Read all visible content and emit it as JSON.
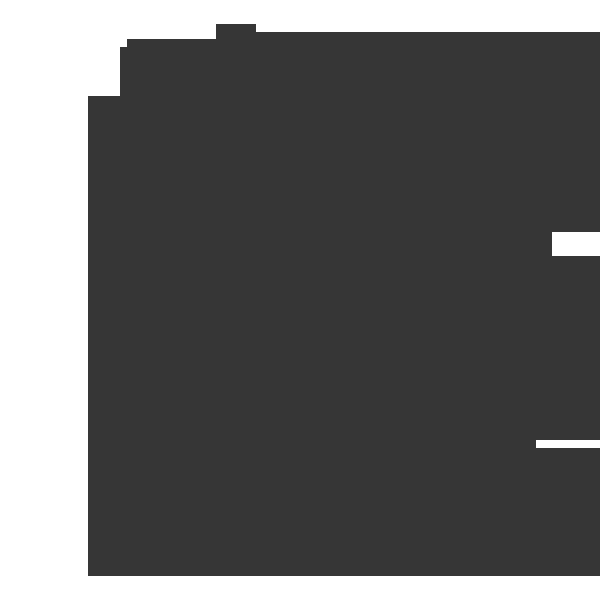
{
  "canvas": {
    "width": 600,
    "height": 600,
    "background_color": "#ffffff"
  },
  "silhouette": {
    "description": "uniform dark flat silhouette of a window-like shape with a tab bump on its stepped top edge and two small white notches on its right edge; no text or interior detail visible",
    "color": "#363636",
    "bottom": 576,
    "columns": [
      {
        "x": 88,
        "width": 32,
        "top": 96,
        "bottom": 576
      },
      {
        "x": 120,
        "width": 7,
        "top": 47,
        "bottom": 576
      },
      {
        "x": 127,
        "width": 89,
        "top": 39,
        "bottom": 576
      },
      {
        "x": 216,
        "width": 40,
        "top": 24,
        "bottom": 576
      },
      {
        "x": 256,
        "width": 344,
        "top": 32,
        "bottom": 576
      }
    ],
    "cutouts": [
      {
        "x": 552,
        "y": 232,
        "width": 48,
        "height": 24
      },
      {
        "x": 536,
        "y": 440,
        "width": 64,
        "height": 8
      }
    ]
  }
}
